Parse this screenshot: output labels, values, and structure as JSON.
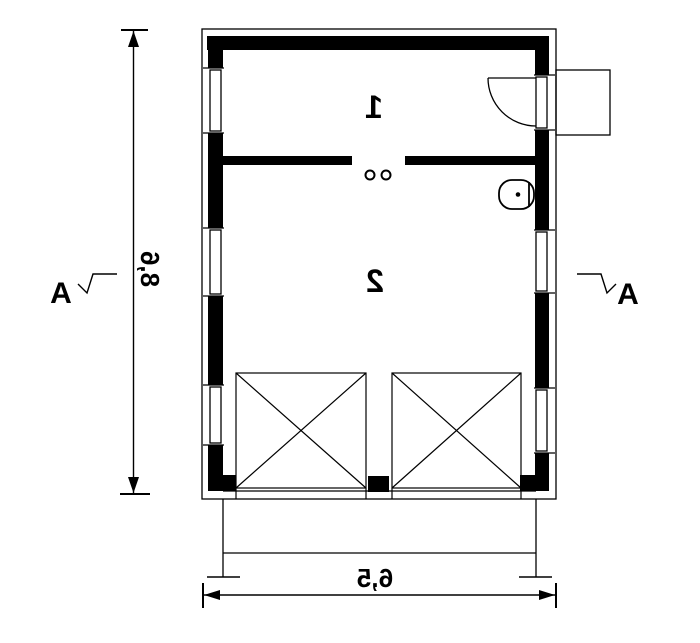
{
  "plan": {
    "type": "architectural-floor-plan",
    "rooms": [
      {
        "number": "1"
      },
      {
        "number": "2"
      }
    ],
    "dimensions": {
      "vertical_label": "8,6",
      "horizontal_label": "6,5"
    },
    "section_markers": {
      "left_label": "A",
      "right_label": "A"
    },
    "symbols": [
      "window-symbol",
      "entrance-door-swing-symbol",
      "entry-porch-outline",
      "wc-toilet-symbol",
      "interior-wall-posts",
      "garage-door-cross-symbol",
      "apron-outline"
    ],
    "colors": {
      "ink": "#000000",
      "paper": "#ffffff"
    }
  }
}
